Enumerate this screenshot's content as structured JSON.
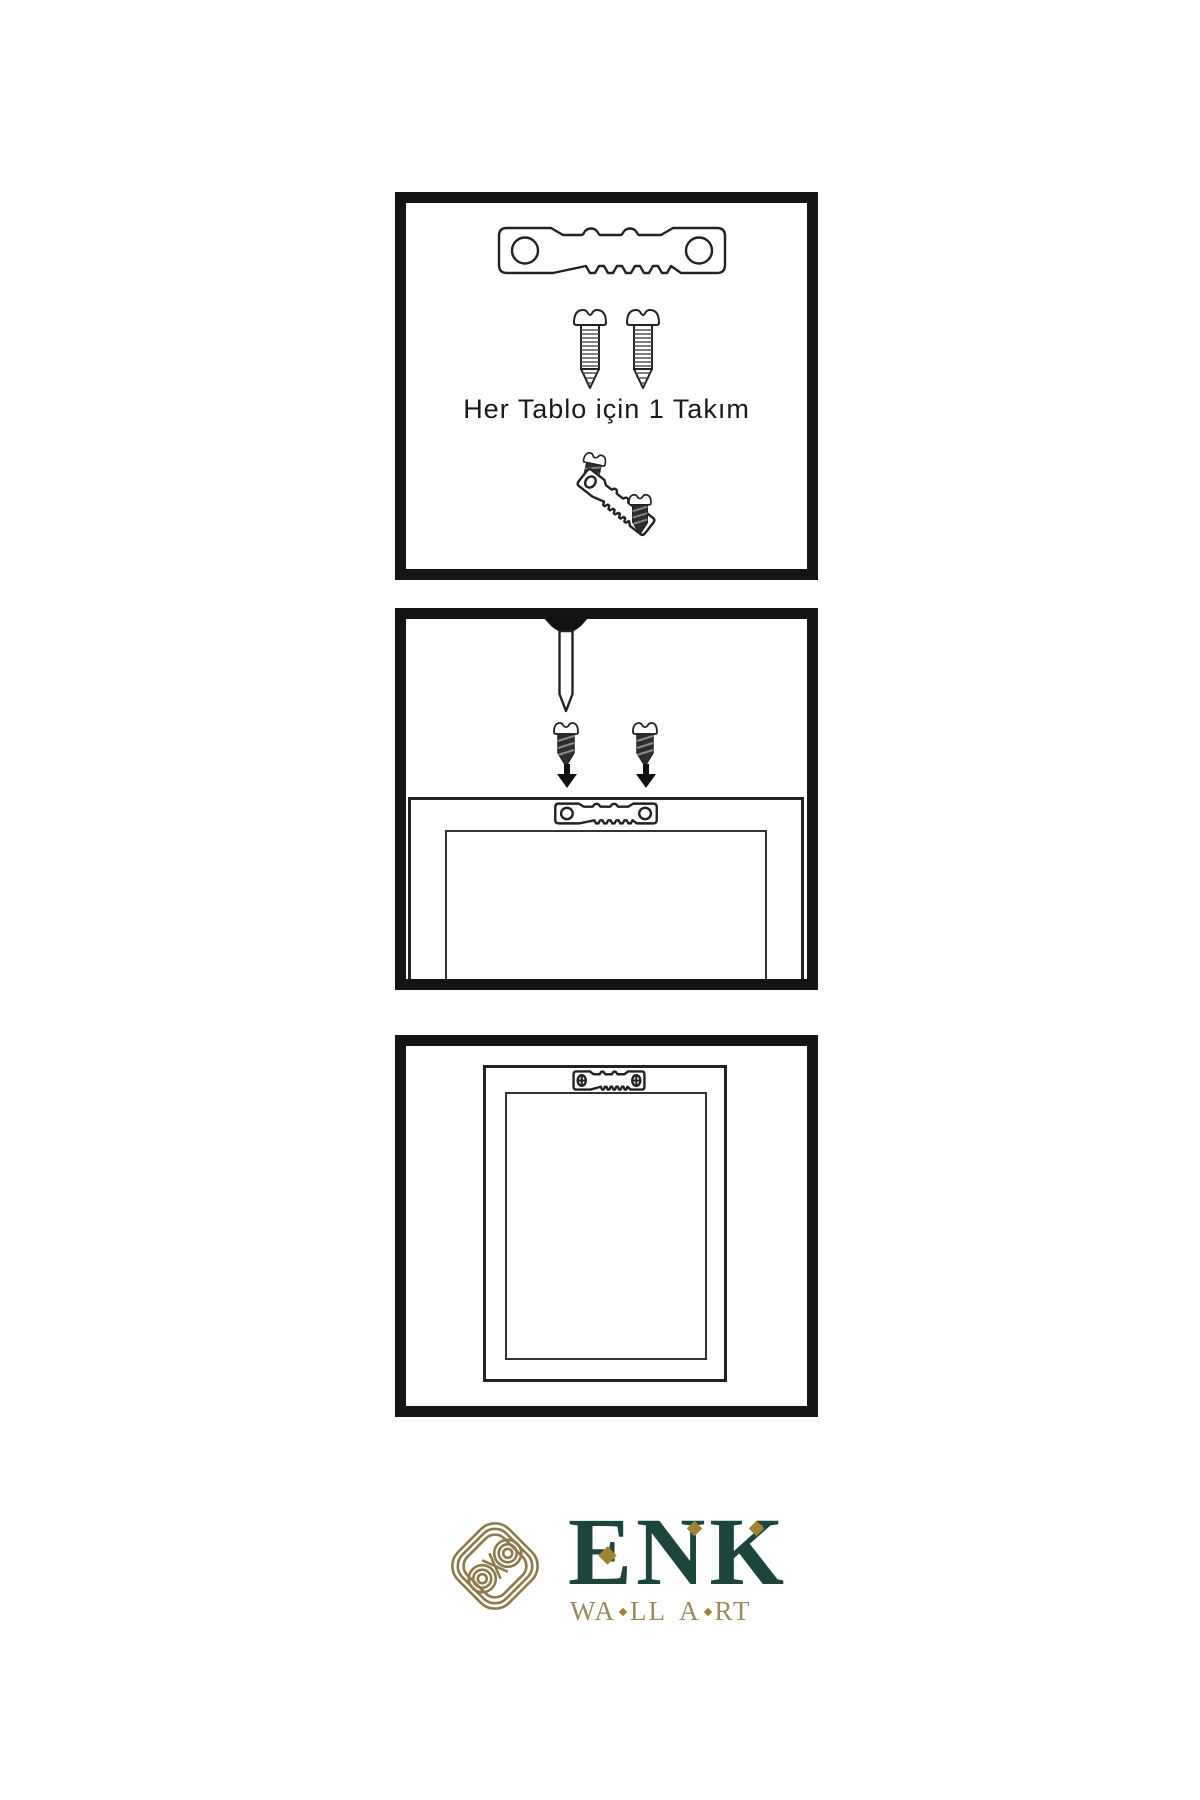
{
  "instructions": {
    "step1": {
      "caption": "Her Tablo için 1 Takım",
      "icons": [
        "sawtooth-hanger-icon",
        "screw-icon",
        "screw-icon",
        "screw-icon",
        "tilted-sawtooth-hanger-icon",
        "screw-icon"
      ]
    },
    "step2": {
      "icons": [
        "nail-icon",
        "screw-icon",
        "arrow-down-icon",
        "screw-icon",
        "arrow-down-icon",
        "picture-frame",
        "sawtooth-hanger-icon"
      ]
    },
    "step3": {
      "icons": [
        "picture-frame",
        "mounted-sawtooth-hanger-icon"
      ]
    }
  },
  "logo": {
    "emblem": "knot-emblem-icon",
    "brand": "ENK",
    "tagline": "WALL ART",
    "tagline_segments": {
      "s1": "WA",
      "s2": "LL",
      "s3": "A",
      "s4": "RT"
    }
  },
  "colors": {
    "panel_border": "#141414",
    "line_dark": "#222222",
    "screw_dark": "#2e2e2e",
    "brand_green": "#1c463c",
    "emblem_gold": "#8c7a4a",
    "tagline_gold": "#9a8a5e",
    "diamond_gold": "#a08434"
  }
}
